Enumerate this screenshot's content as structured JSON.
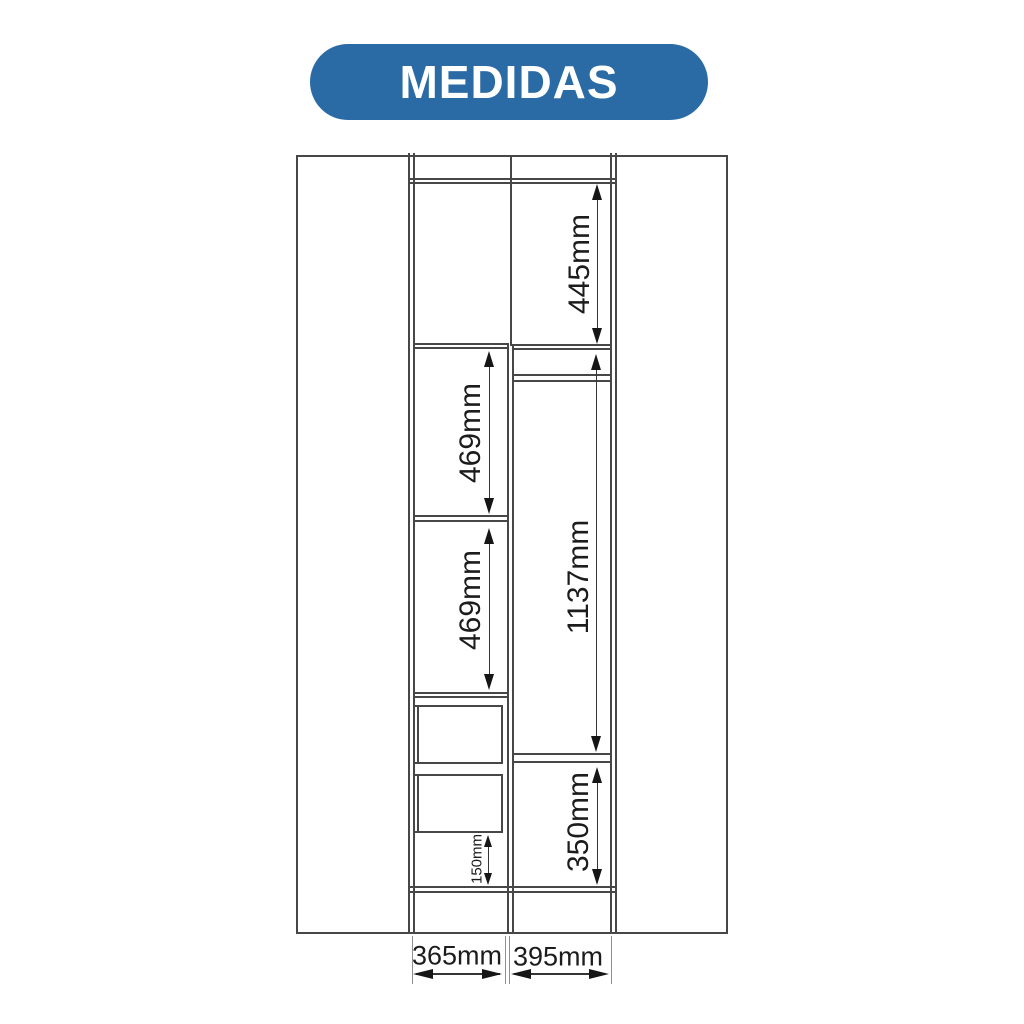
{
  "badge": {
    "label": "MEDIDAS",
    "bg_color": "#2a6ba5",
    "text_color": "#ffffff"
  },
  "diagram": {
    "line_color": "#474747",
    "dimensions": {
      "top_right_section_height": "445mm",
      "left_upper_section_height": "469mm",
      "left_middle_section_height": "469mm",
      "right_hanging_section_height": "1137mm",
      "right_lower_section_height": "350mm",
      "left_bottom_gap_height": "150mm",
      "left_column_width": "365mm",
      "right_column_width": "395mm"
    }
  }
}
